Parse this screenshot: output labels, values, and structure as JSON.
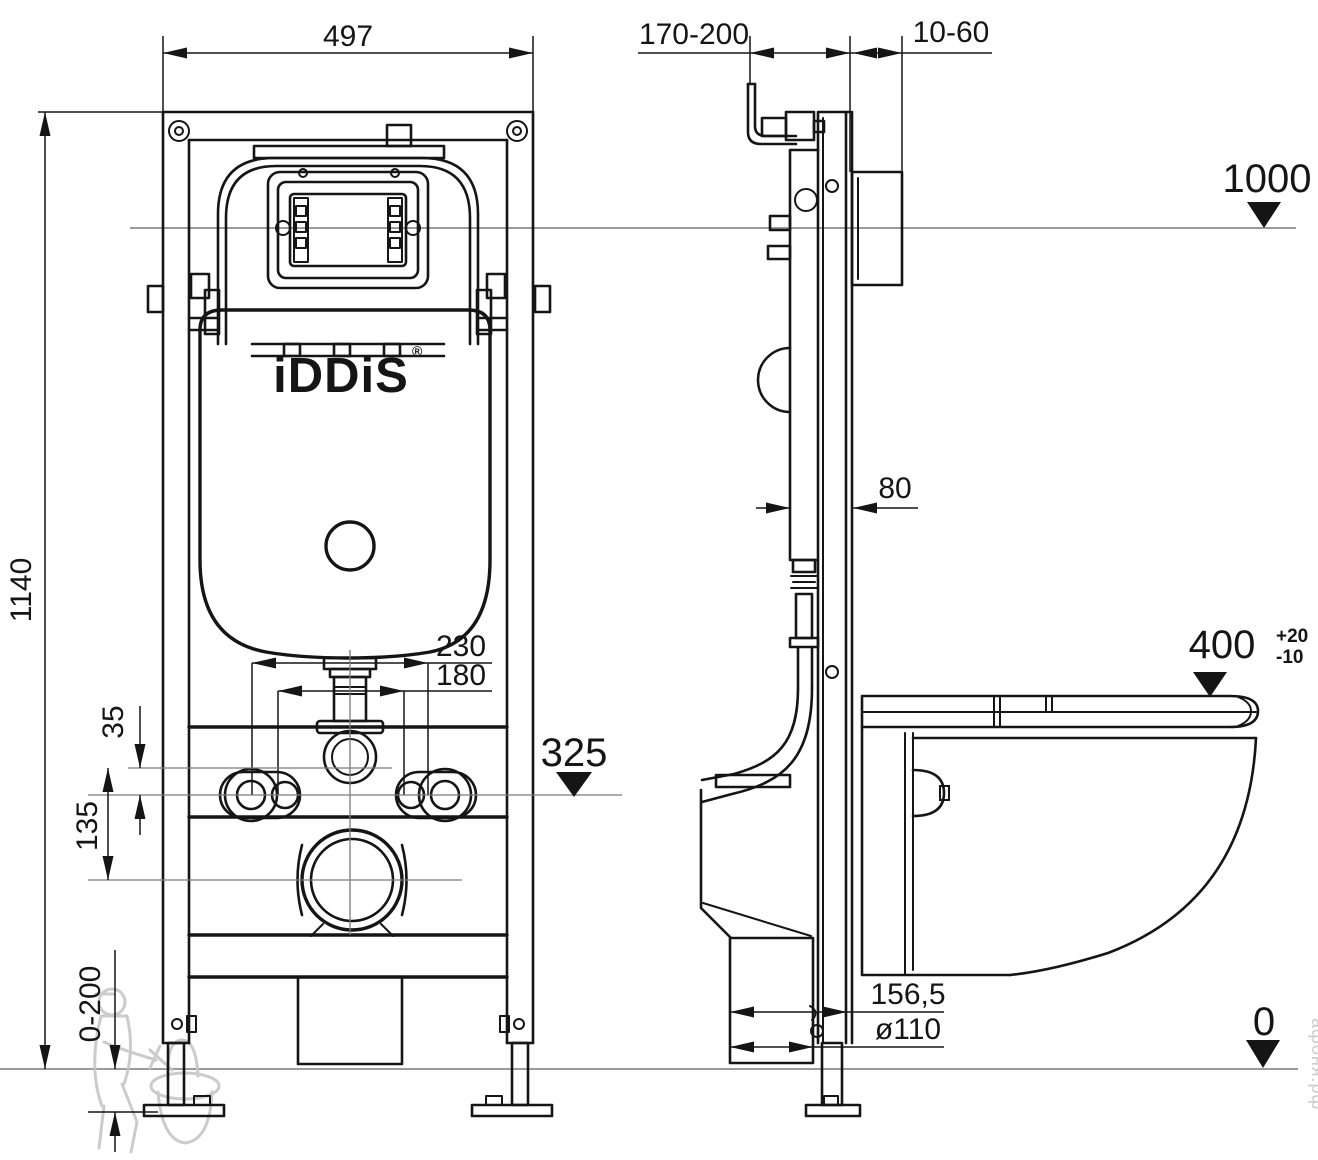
{
  "front": {
    "dim_width": "497",
    "dim_height": "1140",
    "dim_bolts_outer": "230",
    "dim_bolts_inner": "180",
    "dim_offset_small": "35",
    "dim_offset_drain": "135",
    "dim_level_outlet": "325",
    "dim_leg_adjust": "0-200",
    "logo": "iDDiS",
    "registered": "®"
  },
  "side": {
    "dim_wall_offset": "170-200",
    "dim_finish_layer": "10-60",
    "dim_frame_depth": "80",
    "dim_level_button": "1000",
    "dim_seat_height": "400",
    "dim_seat_tol_plus": "+20",
    "dim_seat_tol_minus": "-10",
    "dim_outlet_offset": "156,5",
    "dim_outlet_diameter": "ø110",
    "dim_floor_level": "0"
  },
  "watermark": {
    "site": "афоня.рф"
  },
  "colors": {
    "line": "#151515",
    "reference": "#8d8d8d",
    "watermark": "#c6c6c6",
    "background": "#ffffff"
  }
}
